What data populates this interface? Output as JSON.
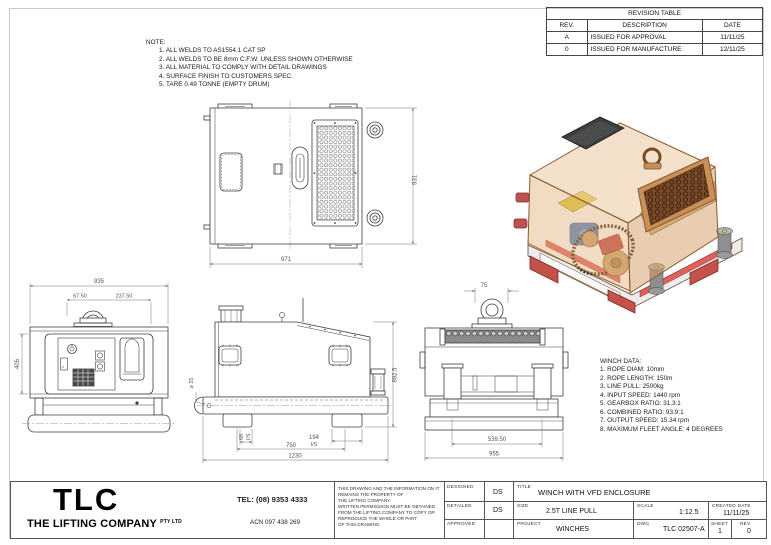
{
  "revision_table": {
    "title": "REVISION TABLE",
    "headers": {
      "rev": "REV.",
      "description": "DESCRIPTION",
      "date": "DATE"
    },
    "rows": [
      {
        "rev": "A",
        "description": "ISSUED FOR APPROVAL",
        "date": "11/11/25"
      },
      {
        "rev": "0",
        "description": "ISSUED FOR MANUFACTURE",
        "date": "12/11/25"
      }
    ]
  },
  "notes": {
    "title": "NOTE:",
    "items": [
      "1. ALL WELDS TO AS1554.1 CAT SP",
      "2. ALL WELDS TO BE 8mm C.F.W. UNLESS SHOWN OTHERWISE",
      "3. ALL MATERIAL TO COMPLY WITH DETAIL DRAWINGS",
      "4. SURFACE FINISH TO CUSTOMERS SPEC.",
      "5. TARE 0.49 TONNE (EMPTY DRUM)"
    ]
  },
  "winch_data": {
    "title": "WINCH DATA:",
    "items": [
      "1. ROPE DIAM: 10mm",
      "2. ROPE LENGTH: 150m",
      "3. LINE PULL: 2500kg",
      "4. INPUT SPEED: 1440 rpm",
      "5. GEARBOX RATIO: 31.3:1",
      "6. COMBINED RATIO: 93.9:1",
      "7. OUTPUT SPEED: 15.34 rpm",
      "8. MAXIMUM FLEET ANGLE: 4 DEGREES"
    ]
  },
  "dims": {
    "top": {
      "height": "931",
      "width": "971"
    },
    "front": {
      "width": "935",
      "eye_left": "67.50",
      "eye_right": "237.50",
      "height": "405"
    },
    "side": {
      "height": "892.5",
      "hole": "⌀ 25",
      "inner": "68",
      "inner_suffix": "I/S",
      "spacing": "750",
      "foot": "194",
      "foot_suffix": "I/S",
      "overall": "1230"
    },
    "rear": {
      "eye": "75",
      "legs": "539.50",
      "base": "955"
    }
  },
  "iso_colors": {
    "enclosure": "#dfae76",
    "lid": "#3c3e40",
    "motor": "#4d7fc4",
    "chain": "#3a2a1a",
    "drum": "#d9b886",
    "vent": "#7a4a28",
    "base_red": "#c4524a",
    "rail": "#ececec",
    "foot": "#8f8f8f",
    "foot_cap": "#c7d04a",
    "yellow_box": "#ddc83d"
  },
  "title_block": {
    "logo": "TLC",
    "company": "THE LIFTING COMPANY",
    "company_suffix": "PTY LTD",
    "tel": "TEL: (08) 9353 4333",
    "acn": "ACN 097 438 269",
    "disclaimer": "THIS DRAWING AND THE INFORMATION ON IT\nREMAINS THE PROPERTY OF\nTHE LIFTING COMPANY.\nWRITTEN PERMISSION MUST BE OBTAINED\nFROM THE LIFTING COMPANY TO COPY OR\nREPRODUCE THE WHOLE OR PART\nOF THIS DRAWING.",
    "designed_label": "DESIGNED",
    "designed_value": "DS",
    "detailed_label": "DETAILED",
    "detailed_value": "DS",
    "approved_label": "APPROVED",
    "approved_value": "",
    "title_label": "TITLE",
    "title_value": "WINCH WITH VFD ENCLOSURE",
    "size_label": "SIZE",
    "size_value": "2.5T LINE PULL",
    "scale_label": "SCALE",
    "scale_value": "1:12.5",
    "created_label": "CREATED DATE",
    "created_value": "11/11/25",
    "project_label": "PROJECT",
    "project_value": "WINCHES",
    "dwg_label": "DWG",
    "dwg_value": "TLC 02507-A",
    "sheet_label": "SHEET",
    "sheet_value": "1",
    "rev_label": "REV",
    "rev_value": "0"
  }
}
